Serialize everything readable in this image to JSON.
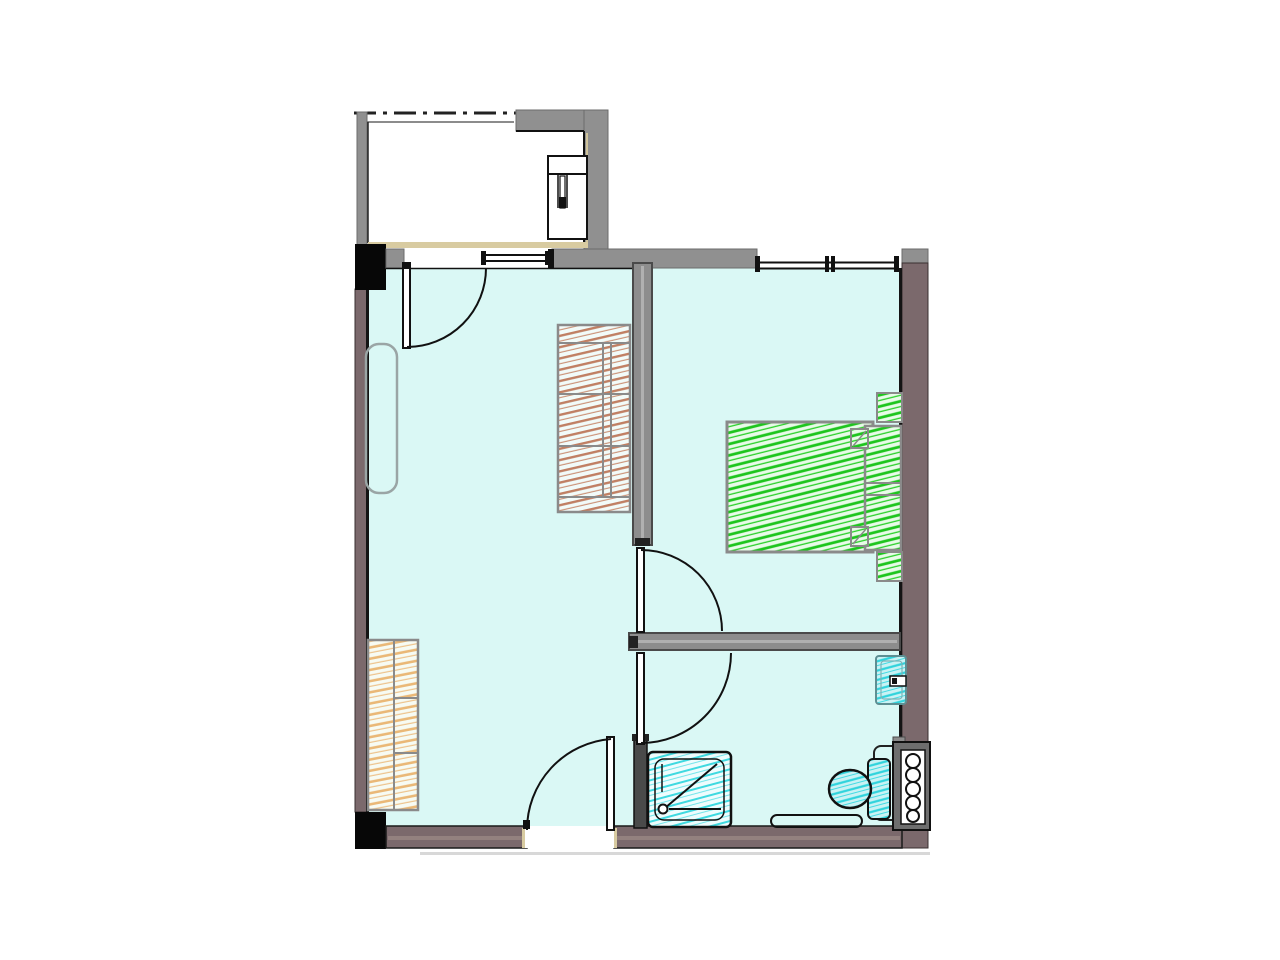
{
  "document": {
    "type": "architectural-floor-plan",
    "description": "CAD floor plan of a one-bedroom apartment with balcony, living room, bedroom and bathroom. No text labels are rendered in the drawing.",
    "text_labels": []
  },
  "palette": {
    "background": "#ffffff",
    "room_floor": "#daf8f5",
    "exterior_wall": "#7b696c",
    "exterior_wall_highlight": "#93817f",
    "interior_wall": "#8d8d8d",
    "interior_wall_edge": "#4a4a4a",
    "balcony_wall": "#909090",
    "column_black": "#070707",
    "sill_tan": "#d8cba1",
    "outline_gray": "#8a8a8a",
    "line_black": "#111111",
    "bed_hatch_green": "#1ec51e",
    "wardrobe_hatch_brown": "#c07f63",
    "wardrobe_hatch_tan": "#eab877",
    "sanitary_hatch_cyan": "#2ed3dc",
    "sanitary_fill_cyan": "#c9f2f4",
    "shadow_gray": "#d8d8d8"
  },
  "rooms": [
    {
      "name": "balcony",
      "position": "top-left",
      "floor": "white"
    },
    {
      "name": "living-room",
      "position": "left",
      "floor": "light-cyan"
    },
    {
      "name": "bedroom",
      "position": "top-right",
      "floor": "light-cyan"
    },
    {
      "name": "bathroom",
      "position": "bottom-right",
      "floor": "light-cyan"
    }
  ],
  "furniture": [
    {
      "name": "water-heater-unit",
      "room": "balcony",
      "style": "outline"
    },
    {
      "name": "radiator",
      "room": "living-room",
      "style": "rounded-outline"
    },
    {
      "name": "tall-wardrobe",
      "room": "living-room",
      "hatch": "brown"
    },
    {
      "name": "entry-wardrobe",
      "room": "living-room",
      "hatch": "tan"
    },
    {
      "name": "double-bed",
      "room": "bedroom",
      "hatch": "green"
    },
    {
      "name": "pillow",
      "room": "bedroom",
      "count": 2,
      "hatch": "green"
    },
    {
      "name": "nightstand",
      "room": "bedroom",
      "count": 2,
      "hatch": "green"
    },
    {
      "name": "shower-tray",
      "room": "bathroom",
      "hatch": "cyan"
    },
    {
      "name": "toilet",
      "room": "bathroom",
      "hatch": "cyan"
    },
    {
      "name": "wash-basin",
      "room": "bathroom",
      "hatch": "cyan"
    },
    {
      "name": "bath-mat",
      "room": "bathroom",
      "style": "outline"
    },
    {
      "name": "plumbing-shaft",
      "room": "bathroom",
      "style": "dark-panel-with-pipes",
      "pipe_count": 5
    }
  ],
  "doors": [
    {
      "name": "balcony-door",
      "from": "balcony",
      "to": "living-room",
      "swing": "into-living-room"
    },
    {
      "name": "entrance-door",
      "from": "outside-bottom",
      "to": "living-room",
      "swing": "into-living-room"
    },
    {
      "name": "bedroom-door",
      "from": "living-room",
      "to": "bedroom",
      "swing": "into-bedroom"
    },
    {
      "name": "bathroom-door",
      "from": "living-room",
      "to": "bathroom",
      "swing": "into-bathroom"
    }
  ],
  "windows": [
    {
      "name": "living-room-window",
      "wall": "north",
      "panes": 1
    },
    {
      "name": "bedroom-window",
      "wall": "north",
      "panes": 2
    }
  ],
  "structure": [
    {
      "name": "property-dash-line",
      "position": "balcony-top"
    },
    {
      "name": "concrete-column",
      "count": 2,
      "position": "left-wall-ends"
    },
    {
      "name": "partition-living-bedroom",
      "type": "interior-wall"
    },
    {
      "name": "partition-bedroom-bathroom",
      "type": "interior-wall"
    },
    {
      "name": "entry-bathroom-stub-wall",
      "type": "thin-wall"
    }
  ]
}
